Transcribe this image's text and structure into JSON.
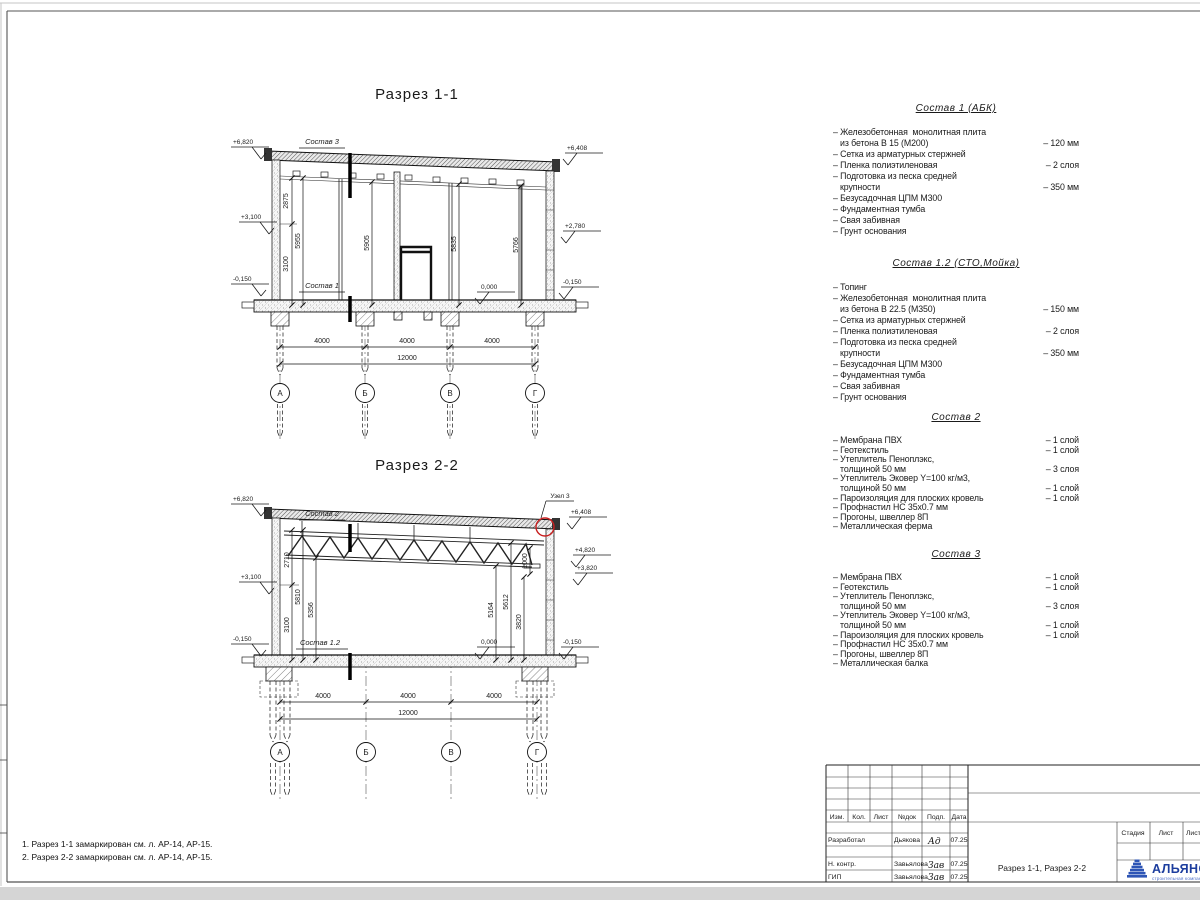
{
  "axes": [
    "А",
    "Б",
    "В",
    "Г"
  ],
  "s11": {
    "title": "Разрез 1-1",
    "comp_top": "Состав 3",
    "comp_bottom": "Состав 1",
    "elev_tl": "+6,820",
    "elev_ml": "+3,100",
    "elev_bl": "-0,150",
    "elev_tr": "+6,408",
    "elev_mr": "+2,780",
    "elev_br": "-0,150",
    "zero": "0,000",
    "d2875": "2875",
    "d5955": "5955",
    "d3100": "3100",
    "d5905": "5905",
    "d5835": "5835",
    "d5766": "5766",
    "span": "4000",
    "total": "12000"
  },
  "s22": {
    "title": "Разрез 2-2",
    "comp_top": "Состав 2",
    "comp_bottom": "Состав 1.2",
    "node": "Узел 3",
    "elev_tl": "+6,820",
    "elev_ml": "+3,100",
    "elev_bl": "-0,150",
    "elev_tr": "+6,408",
    "elev_r2": "+4,820",
    "elev_r3": "+3,820",
    "elev_br": "-0,150",
    "zero": "0,000",
    "d2710": "2710",
    "d5810": "5810",
    "d5356": "5356",
    "d3100": "3100",
    "d1000": "1000",
    "d5612": "5612",
    "d5164": "5164",
    "d3820": "3820",
    "span": "4000",
    "total": "12000"
  },
  "compositions": [
    {
      "title": "Состав 1 (АБК)",
      "rows": [
        {
          "t": "– Железобетонная  монолитная плита",
          "v": ""
        },
        {
          "t": "   из бетона В 15 (М200)",
          "v": "– 120 мм"
        },
        {
          "t": "– Сетка из арматурных стержней",
          "v": ""
        },
        {
          "t": "– Пленка полиэтиленовая",
          "v": "– 2 слоя"
        },
        {
          "t": "– Подготовка из песка средней",
          "v": ""
        },
        {
          "t": "   крупности",
          "v": "– 350 мм"
        },
        {
          "t": "– Безусадочная ЦПМ М300",
          "v": ""
        },
        {
          "t": "– Фундаментная тумба",
          "v": ""
        },
        {
          "t": "– Свая забивная",
          "v": ""
        },
        {
          "t": "– Грунт основания",
          "v": ""
        }
      ]
    },
    {
      "title": "Состав 1.2 (СТО,Мойка)",
      "rows": [
        {
          "t": "– Топинг",
          "v": ""
        },
        {
          "t": "– Железобетонная  монолитная плита",
          "v": ""
        },
        {
          "t": "   из бетона В 22.5 (М350)",
          "v": "– 150 мм"
        },
        {
          "t": "– Сетка из арматурных стержней",
          "v": ""
        },
        {
          "t": "– Пленка полиэтиленовая",
          "v": "– 2 слоя"
        },
        {
          "t": "– Подготовка из песка средней",
          "v": ""
        },
        {
          "t": "   крупности",
          "v": "– 350 мм"
        },
        {
          "t": "– Безусадочная ЦПМ М300",
          "v": ""
        },
        {
          "t": "– Фундаментная тумба",
          "v": ""
        },
        {
          "t": "– Свая забивная",
          "v": ""
        },
        {
          "t": "– Грунт основания",
          "v": ""
        }
      ]
    },
    {
      "title": "Состав 2",
      "rows": [
        {
          "t": "– Мембрана ПВХ",
          "v": "– 1 слой"
        },
        {
          "t": "– Геотекстиль",
          "v": "– 1 слой"
        },
        {
          "t": "– Утеплитель Пеноплэкс,",
          "v": ""
        },
        {
          "t": "   толщиной 50 мм",
          "v": "– 3 слоя"
        },
        {
          "t": "– Утеплитель Эковер Y=100 кг/м3,",
          "v": ""
        },
        {
          "t": "   толщиной 50 мм",
          "v": "– 1 слой"
        },
        {
          "t": "– Пароизоляция для плоских кровель",
          "v": "– 1 слой"
        },
        {
          "t": "– Профнастил НС 35х0.7 мм",
          "v": ""
        },
        {
          "t": "– Прогоны, швеллер 8П",
          "v": ""
        },
        {
          "t": "– Металлическая ферма",
          "v": ""
        }
      ]
    },
    {
      "title": "Состав 3",
      "rows": [
        {
          "t": "– Мембрана ПВХ",
          "v": "– 1 слой"
        },
        {
          "t": "– Геотекстиль",
          "v": "– 1 слой"
        },
        {
          "t": "– Утеплитель Пеноплэкс,",
          "v": ""
        },
        {
          "t": "   толщиной 50 мм",
          "v": "– 3 слоя"
        },
        {
          "t": "– Утеплитель Эковер Y=100 кг/м3,",
          "v": ""
        },
        {
          "t": "   толщиной 50 мм",
          "v": "– 1 слой"
        },
        {
          "t": "– Пароизоляция для плоских кровель",
          "v": "– 1 слой"
        },
        {
          "t": "– Профнастил НС 35х0.7 мм",
          "v": ""
        },
        {
          "t": "– Прогоны, швеллер 8П",
          "v": ""
        },
        {
          "t": "– Металлическая балка",
          "v": ""
        }
      ]
    }
  ],
  "notes": [
    "1. Разрез 1-1 замаркирован см. л. АР-14, АР-15.",
    "2. Разрез 2-2 замаркирован см. л. АР-14, АР-15."
  ],
  "titleblock": {
    "header": [
      "Изм.",
      "Кол.",
      "Лист",
      "№док",
      "Подп.",
      "Дата"
    ],
    "rows": [
      {
        "role": "Разработал",
        "name": "Дьякова",
        "sig": "Ад",
        "date": "07.25"
      },
      {
        "role": "Н. контр.",
        "name": "Завьялова",
        "sig": "Зав",
        "date": "07.25"
      },
      {
        "role": "ГИП",
        "name": "Завьялова",
        "sig": "Зав",
        "date": "07.25"
      }
    ],
    "doc_title": "Разрез 1-1, Разрез 2-2",
    "stage_header": [
      "Стадия",
      "Лист",
      "Листов"
    ],
    "company": "АЛЬЯНС",
    "company_sub": "строительная компания",
    "brand_color": "#1d3e9e",
    "node_circle_color": "#c82020"
  }
}
